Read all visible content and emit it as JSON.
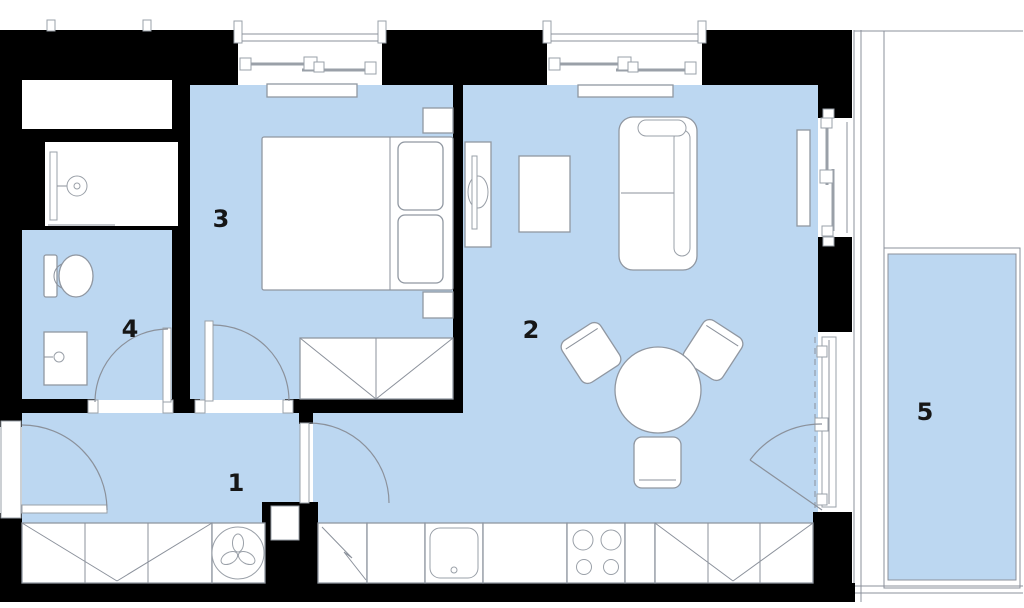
{
  "plan": {
    "name": "apartment-floor-plan",
    "rooms": [
      {
        "id": "1",
        "label": "1",
        "name": "hallway"
      },
      {
        "id": "2",
        "label": "2",
        "name": "living-room-with-kitchen"
      },
      {
        "id": "3",
        "label": "3",
        "name": "bedroom"
      },
      {
        "id": "4",
        "label": "4",
        "name": "bathroom"
      },
      {
        "id": "5",
        "label": "5",
        "name": "balcony"
      }
    ],
    "fixtures": [
      "double-bed",
      "nightstand",
      "wardrobe",
      "sofa",
      "coffee-table",
      "tv-stand",
      "dining-table",
      "chair",
      "kitchen-counter",
      "sink",
      "stove",
      "fridge",
      "washing-machine",
      "shower",
      "toilet",
      "vanity-sink",
      "window",
      "door",
      "radiator"
    ],
    "colors": {
      "floor": "#bcd7f1",
      "wall": "#000000",
      "outline": "#8b919b",
      "fixture_fill": "#ffffff",
      "label": "#161616"
    }
  }
}
